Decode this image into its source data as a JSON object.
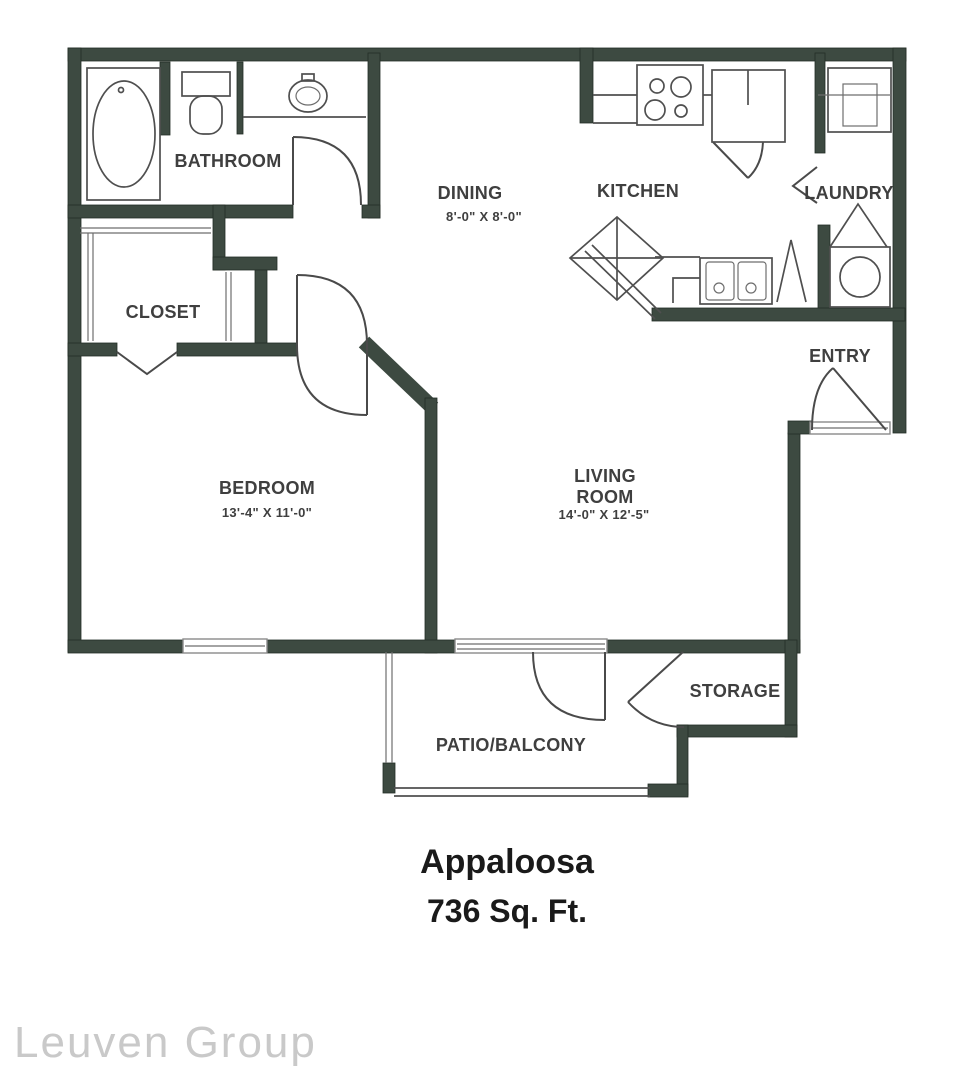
{
  "floorplan": {
    "unit_name": "Appaloosa",
    "unit_area": "736 Sq. Ft.",
    "watermark": "Leuven Group",
    "rooms": {
      "bathroom": {
        "label": "BATHROOM"
      },
      "closet": {
        "label": "CLOSET"
      },
      "bedroom": {
        "label": "BEDROOM",
        "dimensions": "13'-4\" X 11'-0\""
      },
      "dining": {
        "label": "DINING",
        "dimensions": "8'-0\" X 8'-0\""
      },
      "kitchen": {
        "label": "KITCHEN"
      },
      "laundry": {
        "label": "LAUNDRY"
      },
      "entry": {
        "label": "ENTRY"
      },
      "living_room": {
        "label_line1": "LIVING",
        "label_line2": "ROOM",
        "dimensions": "14'-0\" X 12'-5\""
      },
      "storage": {
        "label": "STORAGE"
      },
      "patio": {
        "label": "PATIO/BALCONY"
      }
    },
    "colors": {
      "background": "#ffffff",
      "wall": "#3d4a41",
      "fixture_line": "#4f4f4f",
      "label_text": "#3f3f3f",
      "title_text": "#1a1a1a",
      "watermark_text": "#c9c9c9"
    }
  }
}
